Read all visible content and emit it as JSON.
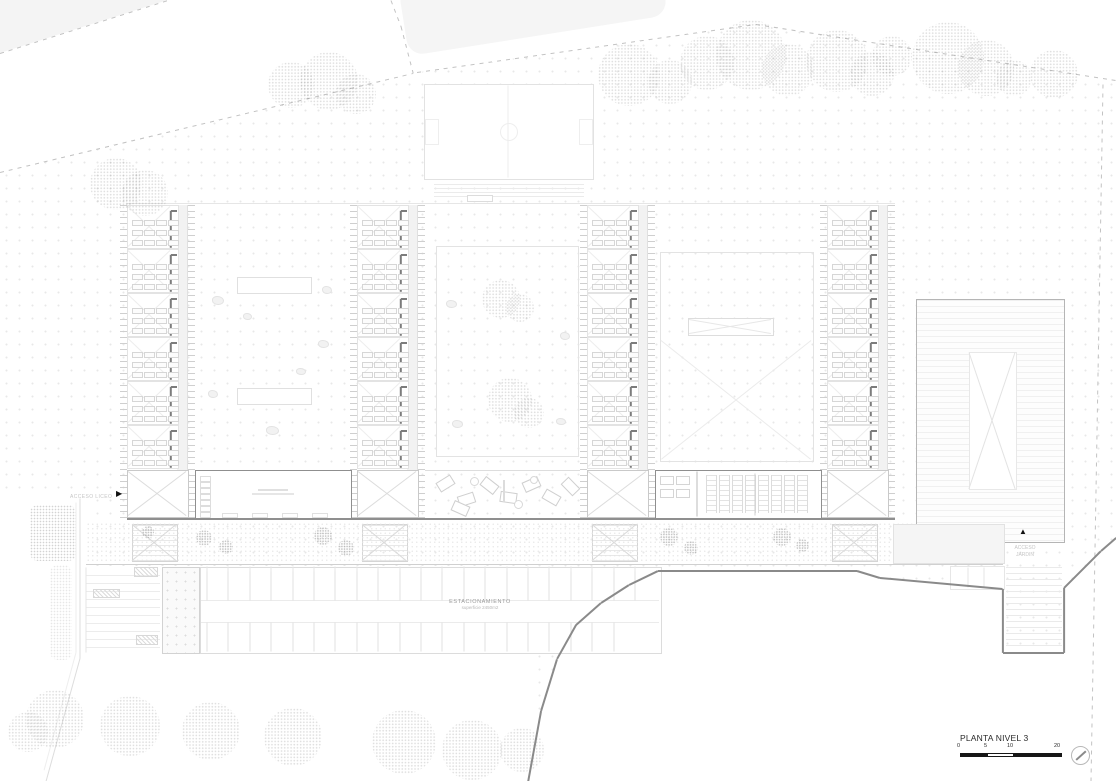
{
  "document": {
    "type": "architectural-floor-plan"
  },
  "title_block": {
    "title": "PLANTA NIVEL 3",
    "scale_ticks": [
      "0",
      "5",
      "10",
      "20"
    ]
  },
  "labels": {
    "parking_title": "ESTACIONAMIENTO",
    "parking_area": "superficie 2450m2",
    "access_left": "ACCESO LICEO",
    "access_garden_line1": "ACCESO",
    "access_garden_line2": "JARDIN"
  },
  "icons": {
    "access_arrow_right": "▶",
    "access_arrow_up": "▲"
  },
  "colors": {
    "paper": "#ffffff",
    "wall_dark": "#7c7c7c",
    "roof_edge": "#8f8f8f",
    "contour": "#8a8a8a",
    "boundary_dash": "#c2c2c2",
    "pattern_dot": "#e8e8e8",
    "parcel_fill": "#f4f4f4",
    "corridor_fill": "#f2f2f2",
    "scalebar_black": "#161616",
    "label_gray": "#9a9a9a",
    "faint_text": "#c6c6c6"
  }
}
